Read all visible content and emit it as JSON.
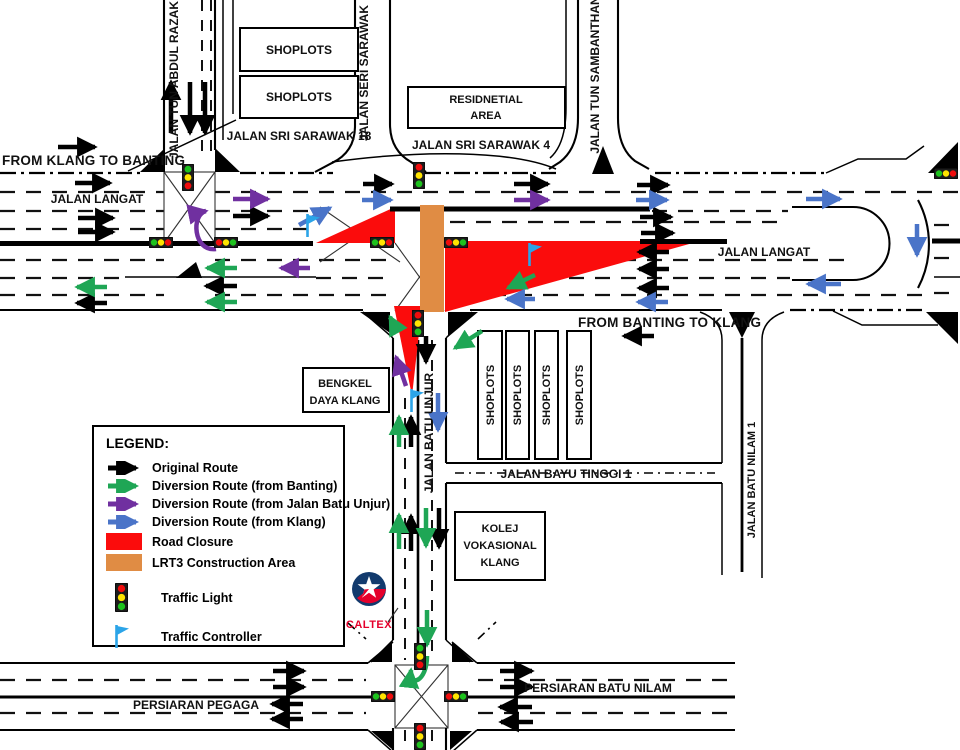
{
  "legend": {
    "title": "LEGEND:",
    "items": [
      {
        "label": "Original Route",
        "color": "#000000",
        "icon": "arrow"
      },
      {
        "label": "Diversion Route (from Banting)",
        "color": "#1fa655",
        "icon": "arrow"
      },
      {
        "label": "Diversion Route (from Jalan Batu Unjur)",
        "color": "#7030a0",
        "icon": "arrow"
      },
      {
        "label": "Diversion Route (from Klang)",
        "color": "#4a74c8",
        "icon": "arrow"
      },
      {
        "label": "Road Closure",
        "color": "#fb0c0c",
        "icon": "swatch"
      },
      {
        "label": "LRT3 Construction Area",
        "color": "#e08c44",
        "icon": "swatch"
      },
      {
        "label": "Traffic Light",
        "icon": "traffic-light"
      },
      {
        "label": "Traffic Controller",
        "color": "#2ba4e8",
        "icon": "flag"
      }
    ]
  },
  "directions": {
    "from_klang_to_banting": "FROM KLANG TO BANTING",
    "from_banting_to_klang": "FROM BANTING TO KLANG"
  },
  "roads": {
    "jalan_langat_left": "JALAN LANGAT",
    "jalan_langat_right": "JALAN LANGAT",
    "jalan_tun_abdul_razak": "JALAN TUN ABDUL RAZAK",
    "jalan_seri_sarawak": "JALAN SERI SARAWAK",
    "jalan_sri_sarawak_18": "JALAN SRI SARAWAK 18",
    "jalan_sri_sarawak_4": "JALAN SRI SARAWAK 4",
    "jalan_tun_sambanthan": "JALAN TUN SAMBANTHAN",
    "jalan_batu_unjur": "JALAN BATU UNJUR",
    "jalan_bayu_tinggi_1": "JALAN BAYU TINGGI 1",
    "jalan_batu_nilam_1": "JALAN BATU NILAM 1",
    "persiaran_pegaga": "PERSIARAN PEGAGA",
    "persiaran_batu_nilam": "PERSIARAN BATU NILAM"
  },
  "places": {
    "shoplots_top_1": "SHOPLOTS",
    "shoplots_top_2": "SHOPLOTS",
    "residential_line1": "RESIDNETIAL",
    "residential_line2": "AREA",
    "bengkel_line1": "BENGKEL",
    "bengkel_line2": "DAYA KLANG",
    "shoplots_row": [
      "SHOPLOTS",
      "SHOPLOTS",
      "SHOPLOTS",
      "SHOPLOTS"
    ],
    "kolej_line1": "KOLEJ",
    "kolej_line2": "VOKASIONAL",
    "kolej_line3": "KLANG",
    "caltex": "CALTEX"
  },
  "colors": {
    "traffic_light_red": "#f00c0c",
    "traffic_light_yellow": "#ffe400",
    "traffic_light_green": "#1ec21e",
    "controller_flag": "#2ba4e8"
  }
}
